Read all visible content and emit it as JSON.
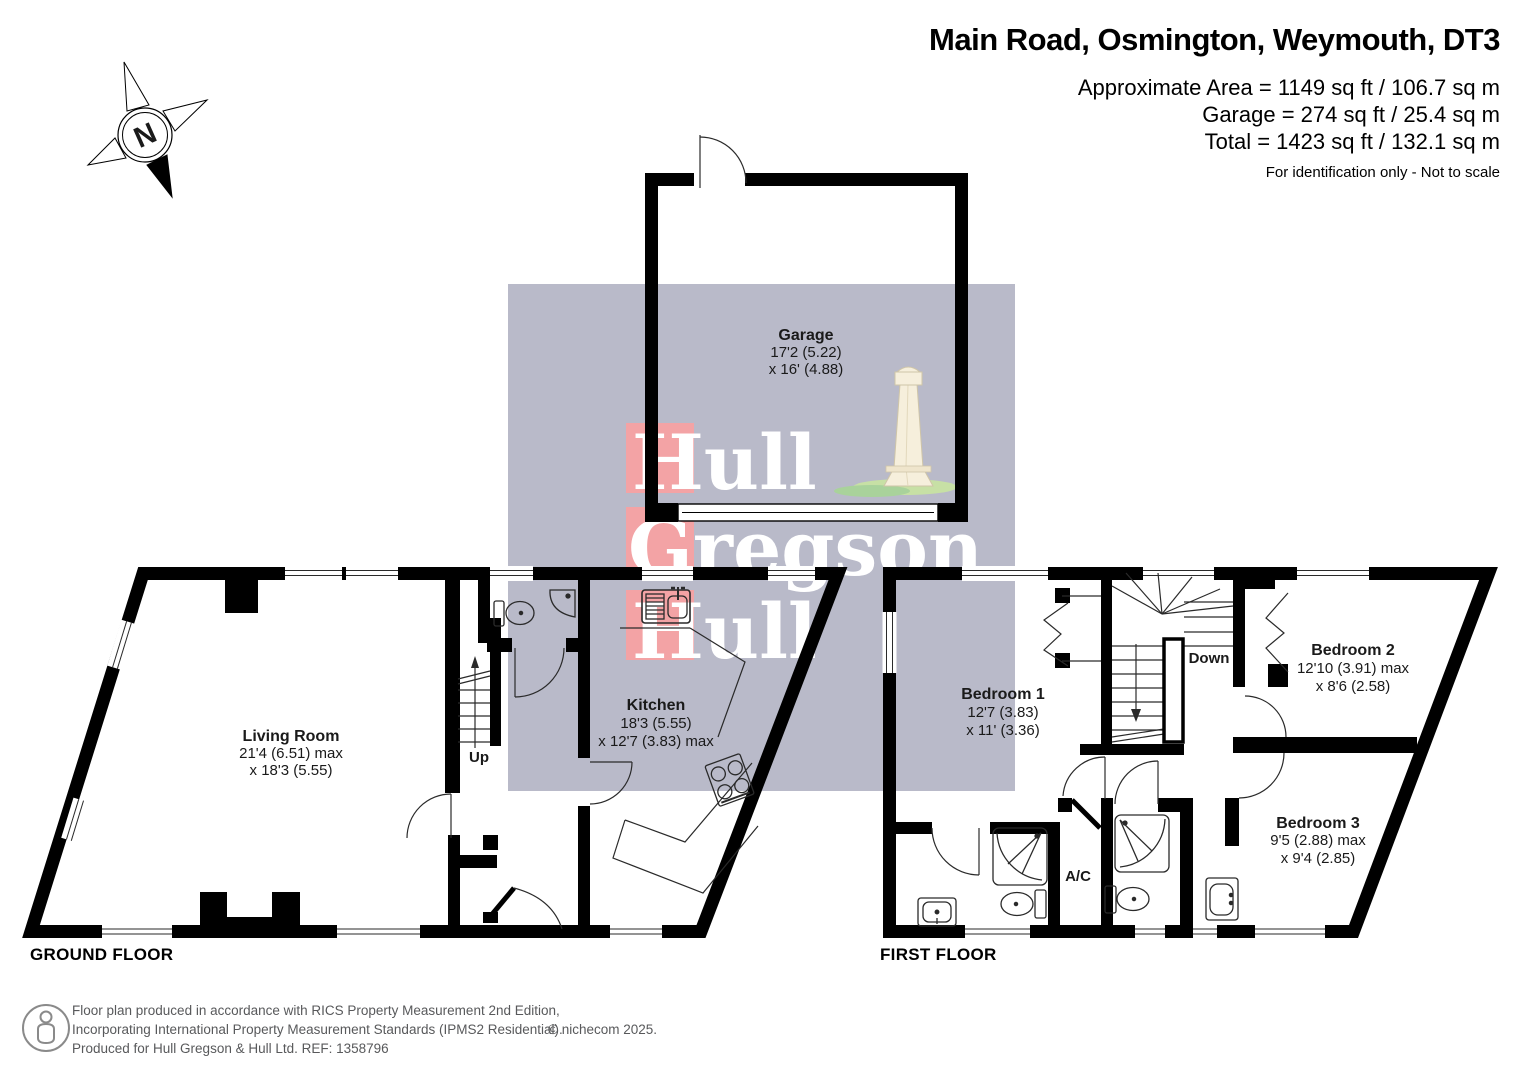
{
  "header": {
    "title": "Main Road, Osmington, Weymouth, DT3",
    "area": "Approximate Area = 1149 sq ft / 106.7 sq m",
    "garage": "Garage = 274 sq ft / 25.4 sq m",
    "total": "Total = 1423 sq ft / 132.1 sq m",
    "disclaimer": "For identification only - Not to scale"
  },
  "compass": {
    "letter": "N"
  },
  "watermark": {
    "word1": "Hull",
    "word2": "Gregson",
    "word3": "Hull",
    "bg_color": "#b9bac9",
    "accent_color": "#f3a3a5"
  },
  "icons": {
    "compass": "north-compass-icon",
    "footer_person": "person-icon",
    "monument": "lighthouse-monument-icon"
  },
  "plans": {
    "garage": {
      "name": "Garage",
      "dim1": "17'2 (5.22)",
      "dim2": "x 16' (4.88)"
    },
    "ground": {
      "label": "GROUND FLOOR",
      "living": {
        "name": "Living Room",
        "dim1": "21'4 (6.51) max",
        "dim2": "x 18'3 (5.55)"
      },
      "kitchen": {
        "name": "Kitchen",
        "dim1": "18'3 (5.55)",
        "dim2": "x 12'7 (3.83) max"
      },
      "up": "Up"
    },
    "first": {
      "label": "FIRST FLOOR",
      "bed1": {
        "name": "Bedroom 1",
        "dim1": "12'7 (3.83)",
        "dim2": "x 11' (3.36)"
      },
      "bed2": {
        "name": "Bedroom 2",
        "dim1": "12'10 (3.91) max",
        "dim2": "x 8'6 (2.58)"
      },
      "bed3": {
        "name": "Bedroom 3",
        "dim1": "9'5 (2.88) max",
        "dim2": "x 9'4 (2.85)"
      },
      "down": "Down",
      "ac": "A/C"
    }
  },
  "footer": {
    "line1": "Floor plan produced in accordance with RICS Property Measurement 2nd Edition,",
    "line2": "Incorporating International Property Measurement Standards (IPMS2 Residential).",
    "line3": "Produced for Hull Gregson & Hull Ltd.   REF: 1358796",
    "copyright": "© nichecom 2025."
  }
}
